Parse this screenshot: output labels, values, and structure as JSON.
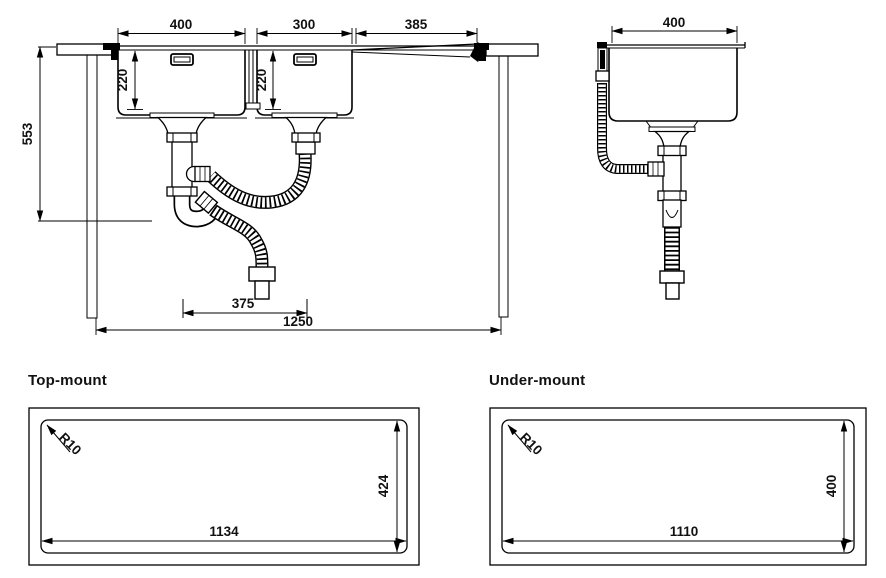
{
  "drawing": {
    "background": "#ffffff",
    "line_color": "#000000",
    "text_color": "#111111"
  },
  "front_view": {
    "description": "front section of double-bowl sink with drainboard and waste plumbing",
    "dims": {
      "bowl1_width": "400",
      "bowl2_width": "300",
      "drainboard_width": "385",
      "bowl1_depth": "220",
      "bowl2_depth": "220",
      "overall_height": "553",
      "drain_spacing": "375",
      "overall_width": "1250"
    }
  },
  "side_view": {
    "description": "side section of sink bowl with overflow and waste pipe",
    "dims": {
      "bowl_width": "400"
    }
  },
  "cutouts": {
    "top_mount": {
      "title": "Top-mount",
      "dims": {
        "corner_radius": "R10",
        "cutout_width": "1134",
        "cutout_height": "424"
      }
    },
    "under_mount": {
      "title": "Under-mount",
      "dims": {
        "corner_radius": "R10",
        "cutout_width": "1110",
        "cutout_height": "400"
      }
    }
  }
}
